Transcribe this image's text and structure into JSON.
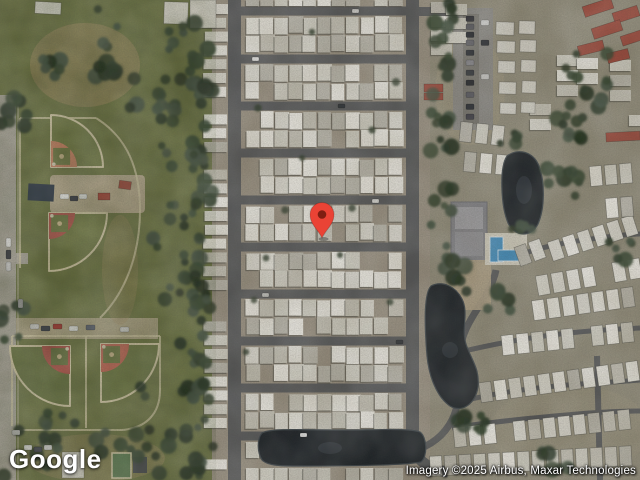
{
  "branding": {
    "logo": "Google"
  },
  "attribution": {
    "text": "Imagery ©2025 Airbus, Maxar Technologies"
  },
  "marker": {
    "x": 322,
    "y": 238,
    "color": "#EA4335",
    "dot_color": "#7E1E12"
  },
  "palette": {
    "ground_right": "#95907e",
    "park_green": "#6f7745",
    "lot": "#9c9384",
    "road": "#595a5c",
    "path": "#d2c8a8",
    "water": "#1c2126",
    "water_edge": "#3d454b",
    "pool": "#4792c4",
    "trailer_shades": [
      "#eceae3",
      "#e0ded6",
      "#f3f1eb",
      "#d6d4ca",
      "#c9c6bb",
      "#bdbab0"
    ],
    "trailer_shadow": "#3a3a33",
    "tree_shades": [
      "#2c3a26",
      "#364630",
      "#22301e",
      "#425140"
    ],
    "red_roof": "#a04a3c",
    "white_bldg": "#dcdad2",
    "navy_roof": "#2e3946",
    "tan": "#ab9a74"
  },
  "map_layout": {
    "trailer_park": {
      "left_road_x": 228,
      "road_w": 13,
      "right_road_x": 406,
      "road_ys": [
        11,
        59,
        106,
        153,
        200,
        247,
        294,
        341,
        388,
        436
      ],
      "x_start": 246,
      "x_end": 402,
      "pitch": 14.3,
      "trailer_w": 12.5,
      "trailer_h": 16.5,
      "extra_rows": [
        [
          246,
          402,
          0,
          6
        ],
        [
          246,
          262,
          442,
          16
        ],
        [
          246,
          402,
          468,
          13
        ]
      ],
      "left_col": {
        "x": 204,
        "w": 23,
        "h": 10,
        "pitch": 13.8,
        "y0": 4,
        "y1": 470,
        "gaps": [
          [
            145,
            166
          ],
          [
            288,
            310
          ],
          [
            424,
            446
          ]
        ]
      }
    },
    "fields": [
      {
        "hx": 51,
        "hy": 167,
        "dir": -45,
        "R": 52,
        "rc": 26,
        "clay": "#c98668",
        "fan": "#747d48"
      },
      {
        "hx": 49,
        "hy": 213,
        "dir": 45,
        "R": 58,
        "rc": 26,
        "clay": "#b35a50",
        "fan": "#747d48"
      },
      {
        "hx": 70,
        "hy": 346,
        "dir": 135,
        "R": 60,
        "rc": 28,
        "clay": "#b35a50",
        "fan": "#6d7846"
      },
      {
        "hx": 101,
        "hy": 344,
        "dir": 45,
        "R": 58,
        "rc": 28,
        "clay": "#c06a58",
        "fan": "#707b47"
      }
    ],
    "right_rows": [
      {
        "x0": 523,
        "y": 255,
        "n": 2,
        "p": 15,
        "a": -20
      },
      {
        "x0": 556,
        "y": 250,
        "n": 6,
        "p": 15.5,
        "a": -18
      },
      {
        "x0": 543,
        "y": 285,
        "n": 7,
        "p": 15.5,
        "a": -10
      },
      {
        "x0": 524,
        "y": 312,
        "n": 8,
        "p": 15,
        "a": -8
      },
      {
        "x0": 508,
        "y": 345,
        "n": 9,
        "p": 15,
        "a": -6
      },
      {
        "x0": 486,
        "y": 392,
        "n": 11,
        "p": 14.8,
        "a": -8
      },
      {
        "x0": 460,
        "y": 437,
        "n": 12,
        "p": 15,
        "a": -6
      },
      {
        "x0": 436,
        "y": 466,
        "n": 14,
        "p": 14.6,
        "a": -3
      },
      {
        "x0": 596,
        "y": 176,
        "n": 3,
        "p": 15,
        "a": -5
      },
      {
        "x0": 612,
        "y": 208,
        "n": 2,
        "p": 15,
        "a": -5
      },
      {
        "x0": 466,
        "y": 132,
        "n": 3,
        "p": 16,
        "a": 6
      },
      {
        "x0": 470,
        "y": 162,
        "n": 3,
        "p": 16,
        "a": 5
      }
    ],
    "right_cols": [
      {
        "x": 557,
        "y0": 55,
        "n": 3,
        "p": 15
      },
      {
        "x": 577,
        "y0": 58,
        "n": 2,
        "p": 15
      },
      {
        "x": 610,
        "y0": 60,
        "n": 3,
        "p": 15
      },
      {
        "x": 629,
        "y0": 100,
        "n": 3,
        "p": 15
      },
      {
        "x": 530,
        "y0": 104,
        "n": 2,
        "p": 15
      },
      {
        "x": 431,
        "y0": 2,
        "n": 4,
        "p": 14
      },
      {
        "x": 446,
        "y0": 4,
        "n": 3,
        "p": 14
      }
    ],
    "white_bldgs": [
      [
        496,
        22,
        18,
        13,
        2
      ],
      [
        519,
        21,
        16,
        13,
        2
      ],
      [
        497,
        41,
        18,
        12,
        2
      ],
      [
        520,
        40,
        16,
        12,
        2
      ],
      [
        498,
        61,
        17,
        12,
        2
      ],
      [
        521,
        60,
        15,
        12,
        2
      ],
      [
        499,
        82,
        17,
        12,
        2
      ],
      [
        522,
        81,
        14,
        12,
        2
      ],
      [
        500,
        103,
        16,
        11,
        2
      ],
      [
        521,
        102,
        14,
        11,
        2
      ],
      [
        164,
        2,
        24,
        22,
        2
      ],
      [
        190,
        0,
        26,
        28,
        0
      ],
      [
        62,
        452,
        22,
        26,
        0
      ],
      [
        35,
        2,
        26,
        12,
        3
      ]
    ],
    "red_bldgs": [
      [
        583,
        2,
        30,
        11,
        -18
      ],
      [
        613,
        9,
        26,
        11,
        -18
      ],
      [
        592,
        24,
        30,
        11,
        -18
      ],
      [
        621,
        33,
        22,
        10,
        -18
      ],
      [
        578,
        43,
        26,
        10,
        -14
      ],
      [
        607,
        51,
        22,
        10,
        -14
      ],
      [
        606,
        132,
        34,
        9,
        -3
      ],
      [
        424,
        84,
        19,
        8,
        0
      ],
      [
        424,
        93,
        19,
        7,
        0
      ],
      [
        98,
        193,
        12,
        7,
        0
      ],
      [
        119,
        181,
        12,
        8,
        8
      ]
    ],
    "dark_bldgs": [
      [
        28,
        184,
        26,
        17,
        3,
        "#2e3946"
      ],
      [
        133,
        457,
        14,
        16,
        0,
        "#4c4f52"
      ]
    ],
    "green_court": [
      112,
      453,
      19,
      25
    ],
    "trees": [
      [
        150,
        60,
        62,
        55,
        26
      ],
      [
        185,
        160,
        28,
        58,
        16
      ],
      [
        175,
        260,
        24,
        45,
        12
      ],
      [
        196,
        350,
        20,
        50,
        12
      ],
      [
        172,
        432,
        42,
        46,
        18
      ],
      [
        105,
        443,
        16,
        12,
        5
      ],
      [
        30,
        452,
        30,
        26,
        10
      ],
      [
        14,
        105,
        15,
        22,
        8
      ],
      [
        12,
        315,
        13,
        26,
        8
      ],
      [
        45,
        70,
        18,
        11,
        6
      ],
      [
        108,
        68,
        13,
        9,
        5
      ],
      [
        60,
        422,
        18,
        10,
        5
      ],
      [
        199,
        115,
        8,
        105,
        20
      ],
      [
        199,
        330,
        8,
        140,
        22
      ],
      [
        441,
        60,
        13,
        58,
        15
      ],
      [
        441,
        180,
        13,
        68,
        15
      ],
      [
        585,
        85,
        28,
        36,
        14
      ],
      [
        563,
        170,
        17,
        30,
        10
      ],
      [
        505,
        140,
        15,
        9,
        5
      ],
      [
        455,
        275,
        15,
        17,
        8
      ],
      [
        500,
        300,
        13,
        11,
        6
      ],
      [
        470,
        420,
        17,
        13,
        7
      ],
      [
        548,
        462,
        20,
        11,
        7
      ],
      [
        620,
        250,
        15,
        11,
        6
      ],
      [
        520,
        230,
        13,
        9,
        5
      ],
      [
        575,
        130,
        20,
        14,
        7
      ]
    ],
    "tree_dots": [
      [
        258,
        108
      ],
      [
        302,
        158
      ],
      [
        352,
        208
      ],
      [
        266,
        258
      ],
      [
        390,
        302
      ],
      [
        246,
        352
      ],
      [
        312,
        32
      ],
      [
        396,
        82
      ],
      [
        285,
        210
      ],
      [
        340,
        255
      ],
      [
        372,
        130
      ],
      [
        254,
        300
      ]
    ],
    "cars": [
      [
        60,
        194,
        9,
        5,
        "#e8e8e8"
      ],
      [
        70,
        196,
        8,
        5,
        "#32343c"
      ],
      [
        79,
        194,
        8,
        5,
        "#d8d8d8"
      ],
      [
        30,
        324,
        9,
        5,
        "#cccccc"
      ],
      [
        41,
        326,
        9,
        5,
        "#3a3f48"
      ],
      [
        53,
        324,
        9,
        5,
        "#a23a32"
      ],
      [
        69,
        326,
        9,
        5,
        "#e0e0e0"
      ],
      [
        86,
        325,
        9,
        5,
        "#596070"
      ],
      [
        120,
        327,
        9,
        5,
        "#cfcfcf"
      ],
      [
        6,
        238,
        5,
        9,
        "#e5e5e5"
      ],
      [
        6,
        250,
        5,
        9,
        "#303338"
      ],
      [
        6,
        262,
        5,
        9,
        "#c8c8c8"
      ],
      [
        18,
        299,
        5,
        9,
        "#98989a"
      ],
      [
        24,
        445,
        8,
        5,
        "#e2e2e2"
      ],
      [
        34,
        447,
        8,
        5,
        "#44474e"
      ],
      [
        44,
        445,
        8,
        5,
        "#cfcfcf"
      ],
      [
        12,
        430,
        8,
        5,
        "#b8b8b8"
      ],
      [
        466,
        16,
        8,
        5.5,
        "#2e2e34"
      ],
      [
        466,
        24,
        8,
        5.5,
        "#55555c"
      ],
      [
        466,
        32,
        8,
        5.5,
        "#1f2228"
      ],
      [
        466,
        40,
        8,
        5.5,
        "#63636a"
      ],
      [
        466,
        50,
        8,
        5.5,
        "#2a2d33"
      ],
      [
        466,
        60,
        8,
        5.5,
        "#8a8a90"
      ],
      [
        466,
        70,
        8,
        5.5,
        "#33363c"
      ],
      [
        466,
        80,
        8,
        5.5,
        "#23252b"
      ],
      [
        466,
        92,
        8,
        5.5,
        "#5e5e66"
      ],
      [
        466,
        104,
        8,
        5.5,
        "#2f3238"
      ],
      [
        466,
        114,
        8,
        5.5,
        "#46464e"
      ],
      [
        481,
        20,
        8,
        5.5,
        "#d8d8d8"
      ],
      [
        481,
        40,
        8,
        5.5,
        "#2c2f35"
      ],
      [
        481,
        74,
        8,
        5.5,
        "#cfcfcf"
      ],
      [
        252,
        57,
        7,
        4,
        "#e8e8e8"
      ],
      [
        338,
        104,
        7,
        4,
        "#2f3338"
      ],
      [
        372,
        199,
        7,
        4,
        "#dddddd"
      ],
      [
        262,
        293,
        7,
        4,
        "#c8c8c8"
      ],
      [
        396,
        340,
        7,
        4,
        "#33363b"
      ],
      [
        300,
        433,
        7,
        4,
        "#e2e2e2"
      ],
      [
        352,
        9,
        7,
        4,
        "#d5d5d5"
      ]
    ]
  }
}
